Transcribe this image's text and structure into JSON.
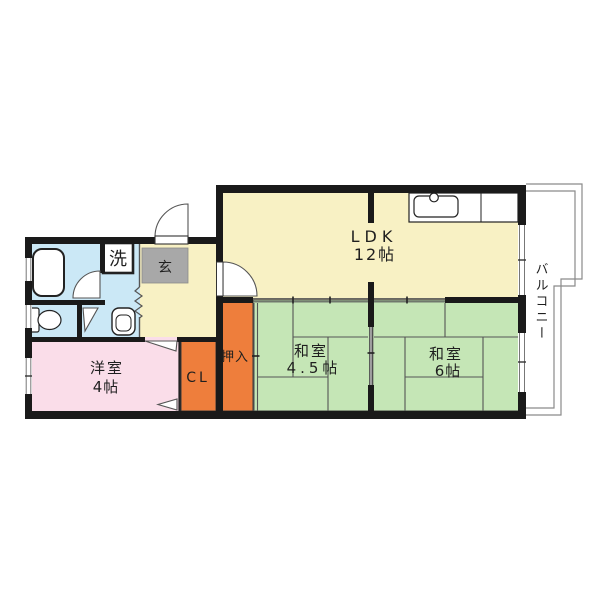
{
  "floorplan": {
    "rooms": {
      "ldk": {
        "name": "LDK",
        "size": "12帖"
      },
      "washitsu45": {
        "name": "和室",
        "size": "4.5帖"
      },
      "washitsu6": {
        "name": "和室",
        "size": "6帖"
      },
      "youshitsu": {
        "name": "洋室",
        "size": "4帖"
      },
      "oshiire": {
        "label": "押入"
      },
      "closet": {
        "label": "CL"
      },
      "genkan": {
        "label": "玄"
      },
      "laundry": {
        "label": "洗"
      },
      "balcony": {
        "label": "バルコニー"
      }
    },
    "colors": {
      "ldk": "#F8F1C4",
      "hall": "#F8F1C4",
      "tatami": "#C5E6B6",
      "western": "#FADDE9",
      "closet": "#EE7E3C",
      "genkan": "#A8A8A8",
      "bath": "#CBE8F6",
      "wall": "#1A1A1A",
      "line": "#555555",
      "fixture": "#FFFFFF",
      "text": "#1F1F1F",
      "railing": "#8A8A8A"
    }
  }
}
